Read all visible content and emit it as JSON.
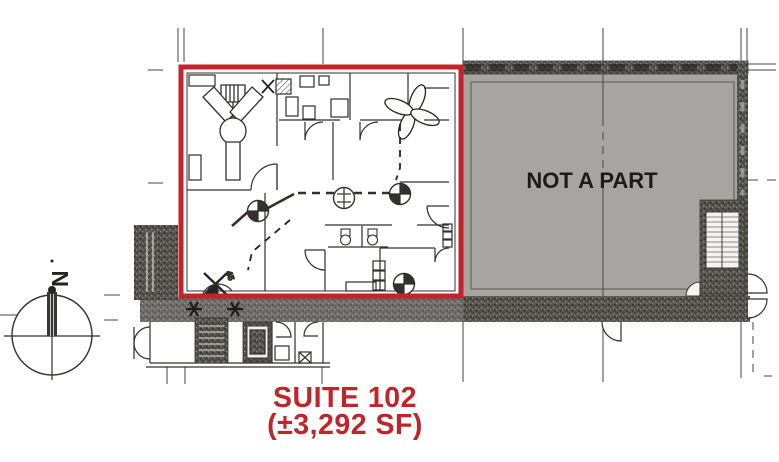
{
  "plan": {
    "suite": {
      "name": "SUITE 102",
      "area": "(±3,292 SF)"
    },
    "excluded_region_label": "NOT A PART",
    "compass_north_label": "N",
    "exit_door_angle_label": "45",
    "colors": {
      "suite_outline_red": "#c3232a",
      "suite_label_red": "#c3232a",
      "excluded_area_gray": "#a7a5a2",
      "wall_speckle_dark": "#55514d",
      "drawing_line": "#33302d",
      "label_black": "#1d1a18",
      "background": "#ffffff"
    }
  }
}
